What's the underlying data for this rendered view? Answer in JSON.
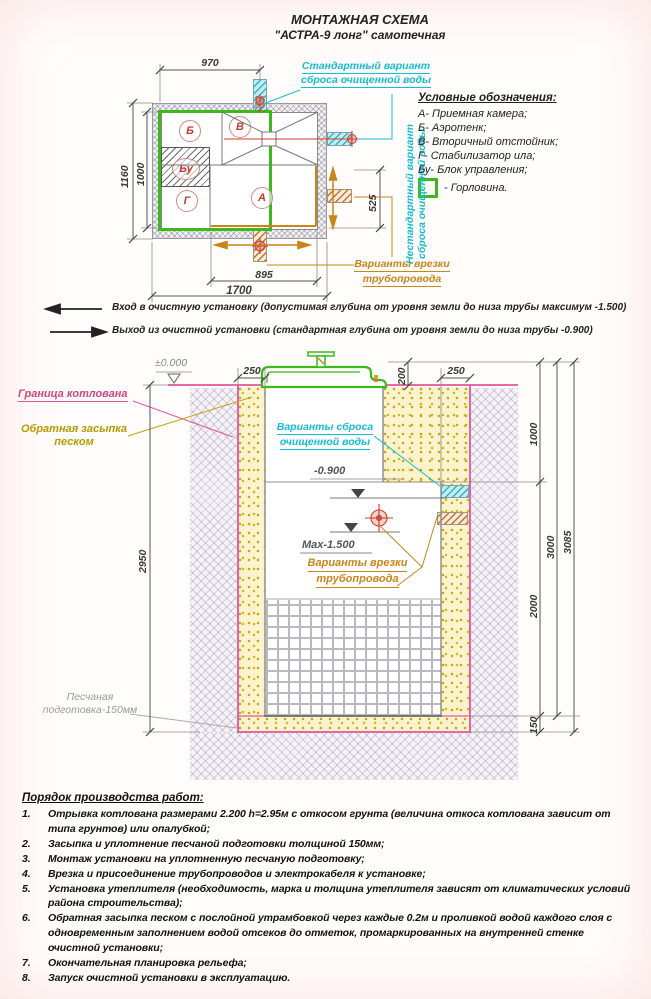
{
  "title": {
    "line1": "МОНТАЖНАЯ СХЕМА",
    "line2": "\"АСТРА-9 лонг\" самотечная"
  },
  "colors": {
    "cyan": "#16bcd4",
    "orange": "#c9841a",
    "green": "#3db81e",
    "pink": "#d2457f",
    "red": "#c23b2e",
    "olive": "#b89b00"
  },
  "plan": {
    "dim_top": "970",
    "dim_left_outer": "1160",
    "dim_left_inner": "1000",
    "dim_right": "525",
    "dim_bottom_inner": "895",
    "dim_bottom_outer": "1700",
    "label_a": "А",
    "label_b": "Б",
    "label_v": "В",
    "label_g": "Г",
    "label_bu": "Бу",
    "standard_line1": "Стандартный вариант",
    "standard_line2": "сброса очищенной воды",
    "nonstandard_line1": "Нестандартный вариант",
    "nonstandard_line2": "сброса очищенной воды",
    "tap_line1": "Варианты врезки",
    "tap_line2": "трубопровода"
  },
  "legend": {
    "heading": "Условные обозначения:",
    "items": [
      "А- Приемная камера;",
      "Б- Аэротенк;",
      "В- Вторичный отстойник;",
      "Г- Стабилизатор ила;",
      "Бу- Блок управления;"
    ],
    "neck": "- Горловина."
  },
  "notes": {
    "inlet": "Вход в очистную установку (допустимая глубина от уровня земли до низа трубы максимум -1.500)",
    "outlet": "Выход из очистной установки (стандартная глубина от уровня земли до низа трубы -0.900)"
  },
  "section": {
    "level_zero": "±0.000",
    "pit_boundary": "Граница котлована",
    "backfill_line1": "Обратная засыпка",
    "backfill_line2": "песком",
    "sandprep_line1": "Песчаная",
    "sandprep_line2": "подготовка-150мм",
    "discharge_line1": "Варианты сброса",
    "discharge_line2": "очищенной воды",
    "level_900": "-0.900",
    "max_1500": "Max-1.500",
    "tap_line1": "Варианты врезки",
    "tap_line2": "трубопровода",
    "dim_250_left": "250",
    "dim_200": "200",
    "dim_250_right": "250",
    "dim_2950": "2950",
    "dim_1000": "1000",
    "dim_2000": "2000",
    "dim_3000": "3000",
    "dim_3085": "3085",
    "dim_150": "150"
  },
  "work_order": {
    "heading": "Порядок производства работ:",
    "items": [
      {
        "num": "1.",
        "text": "Отрывка котлована размерами 2.200 h=2.95м с откосом грунта (величина откоса котлована зависит от типа грунтов) или опалубкой;"
      },
      {
        "num": "2.",
        "text": "Засыпка и уплотнение песчаной подготовки толщиной 150мм;"
      },
      {
        "num": "3.",
        "text": "Монтаж установки на уплотненную песчаную подготовку;"
      },
      {
        "num": "4.",
        "text": "Врезка и присоединение трубопроводов и электрокабеля к установке;"
      },
      {
        "num": "5.",
        "text": "Установка утеплителя (необходимость, марка и толщина утеплителя зависят от климатических условий района строительства);"
      },
      {
        "num": "6.",
        "text": "Обратная засыпка песком с послойной утрамбовкой через каждые 0.2м и проливкой водой каждого слоя с одновременным заполнением водой отсеков до отметок, промаркированных на внутренней стенке очистной установки;"
      },
      {
        "num": "7.",
        "text": "Окончательная планировка рельефа;"
      },
      {
        "num": "8.",
        "text": "Запуск очистной установки в эксплуатацию."
      }
    ]
  }
}
